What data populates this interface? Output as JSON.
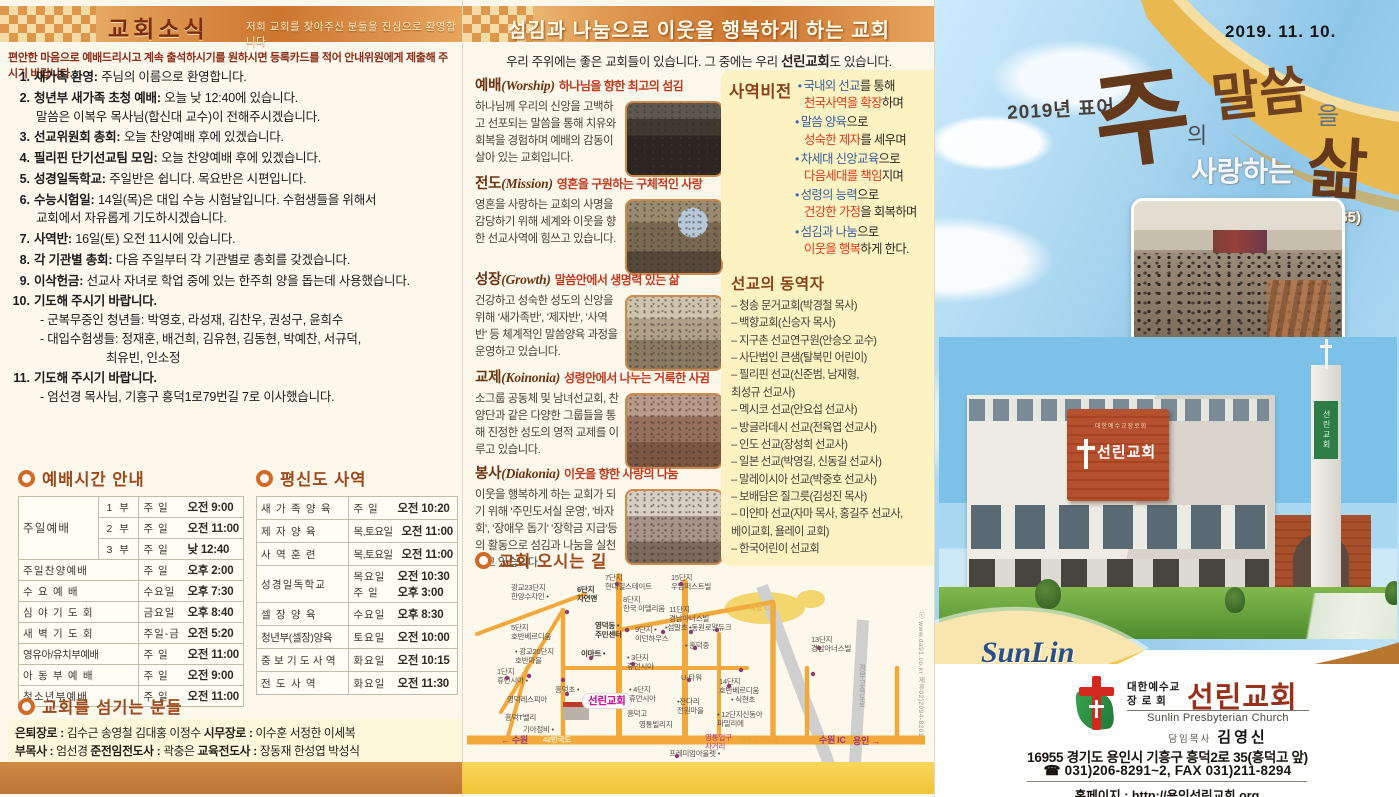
{
  "left": {
    "header": {
      "title": "교회소식",
      "welcome": "저희 교회를 찾아주신 분들을 진심으로 환영합니다"
    },
    "intro": "편안한 마음으로 예배드리시고 계속 출석하시기를 원하시면 등록카드를 적어 안내위원에게 제출해 주시기 바랍니다.",
    "announcements": [
      {
        "n": "1.",
        "t": "새가족 환영:",
        "b": "주님의 이름으로 환영합니다."
      },
      {
        "n": "2.",
        "t": "청년부 새가족 초청 예배:",
        "b": "오늘 낮 12:40에 있습니다.",
        "b2": "말씀은 이복우 목사님(합신대 교수)이 전해주시겠습니다."
      },
      {
        "n": "3.",
        "t": "선교위원회 총회:",
        "b": "오늘 찬양예배 후에 있겠습니다."
      },
      {
        "n": "4.",
        "t": "필리핀 단기선교팀 모임:",
        "b": "오늘 찬양예배 후에 있겠습니다."
      },
      {
        "n": "5.",
        "t": "성경일독학교:",
        "b": "주일반은 쉽니다. 목요반은 시편입니다."
      },
      {
        "n": "6.",
        "t": "수능시험일:",
        "b": "14일(목)은 대입 수능 시험날입니다. 수험생들을 위해서",
        "b2": "교회에서 자유롭게 기도하시겠습니다."
      },
      {
        "n": "7.",
        "t": "사역반:",
        "b": "16일(토) 오전 11시에 있습니다."
      },
      {
        "n": "8.",
        "t": "각 기관별 총회:",
        "b": "다음 주일부터 각 기관별로 총회를 갖겠습니다."
      },
      {
        "n": "9.",
        "t": "이삭헌금:",
        "b": "선교사 자녀로 학업 중에 있는 한주희 양을 돕는데 사용했습니다."
      },
      {
        "n": "10.",
        "t": "기도해 주시기 바랍니다.",
        "s1": "- 군복무중인 청년들: 박영호, 라성재, 김찬우, 권성구, 윤희수",
        "s2": "- 대입수험생들: 정재훈, 배건희, 김유현, 김동현, 박예찬, 서규덕,",
        "s3": "최유빈, 인소정"
      },
      {
        "n": "11.",
        "t": "기도해 주시기 바랍니다.",
        "s1": "- 엄선경 목사님, 기흥구 흥덕1로79번길 7로 이사했습니다."
      }
    ],
    "worship_times": {
      "title": "예배시간 안내",
      "rows": [
        {
          "name": "주일예배",
          "sub": "1 부",
          "day": "주  일",
          "time": "오전 9:00"
        },
        {
          "sub": "2 부",
          "day": "주  일",
          "time": "오전 11:00"
        },
        {
          "sub": "3 부",
          "day": "주  일",
          "time": "낮 12:40"
        },
        {
          "name": "주일찬양예배",
          "day": "주  일",
          "time": "오후 2:00"
        },
        {
          "name": "수 요 예 배",
          "day": "수요일",
          "time": "오후 7:30"
        },
        {
          "name": "심 야 기 도 회",
          "day": "금요일",
          "time": "오후 8:40"
        },
        {
          "name": "새 벽 기 도 회",
          "day": "주일-금",
          "time": "오전 5:20"
        },
        {
          "name": "영유아/유치부예배",
          "day": "주  일",
          "time": "오전 11:00"
        },
        {
          "name": "아 동 부 예 배",
          "day": "주  일",
          "time": "오전 9:00"
        },
        {
          "name": "청소년부예배",
          "day": "주  일",
          "time": "오전 11:00"
        }
      ]
    },
    "lay_ministry": {
      "title": "평신도 사역",
      "rows": [
        {
          "name": "새 가 족 양 육",
          "day": "주  일",
          "time": "오전 10:20"
        },
        {
          "name": "제 자 양 육",
          "day": "목,토요일",
          "time": "오전 11:00"
        },
        {
          "name": "사 역 훈 련",
          "day": "목,토요일",
          "time": "오전 11:00"
        },
        {
          "name": "성경일독학교",
          "day": "목요일",
          "time": "오전 10:30",
          "day2": "주  일",
          "time2": "오후 3:00"
        },
        {
          "name": "셀 장 양 육",
          "day": "수요일",
          "time": "오후 8:30"
        },
        {
          "name": "청년부(셀장)양육",
          "day": "토요일",
          "time": "오전 10:00"
        },
        {
          "name": "중 보 기 도 사 역",
          "day": "화요일",
          "time": "오전 10:15"
        },
        {
          "name": "전 도 사 역",
          "day": "화요일",
          "time": "오전 11:30"
        }
      ]
    },
    "servants": {
      "title": "교회를 섬기는 분들",
      "l1a": "은퇴장로 :",
      "l1b": " 김수근 송영철 김대홍 이정수",
      "l1c": "   시무장로 :",
      "l1d": " 이수훈 서정한 이세복",
      "l2a": "부목사 :",
      "l2b": " 엄선경 ",
      "l2c": "준전임전도사 :",
      "l2d": " 곽충은 ",
      "l2e": "교육전도사 :",
      "l2f": " 장동재 한성엽 박성식",
      "l3a": "지휘:",
      "l3b": " 부성우 ",
      "l3c": "반주:",
      "l3d": " 최현실 김효정 라미영 안소희 노신희 ",
      "l3e": "관현악:",
      "l3f": " 이선자 김윤지 변희정 이찬희"
    }
  },
  "middle": {
    "header": "섬김과 나눔으로 이웃을 행복하게 하는 교회",
    "sub1": "우리 주위에는 좋은 교회들이 있습니다. 그 중에는 우리 ",
    "sub_b": "선린교회",
    "sub2": "도 있습니다.",
    "sections": [
      {
        "name": "예배",
        "en": "(Worship)",
        "tag": "하나님을 향한 최고의 섬김",
        "body": "하나님께 우리의 신앙을 고백하고 선포되는 말씀을 통해 치유와 회복을 경험하며 예배의 감동이 살아 있는 교회입니다."
      },
      {
        "name": "전도",
        "en": "(Mission)",
        "tag": "영혼을 구원하는 구체적인 사랑",
        "body": "영혼을 사랑하는 교회의 사명을 감당하기 위해 세계와 이웃을 향한 선교사역에 힘쓰고 있습니다."
      },
      {
        "name": "성장",
        "en": "(Growth)",
        "tag": "말씀안에서 생명력 있는 삶",
        "body": "건강하고 성숙한 성도의 신앙을 위해 '새가족반', '제자반', '사역반' 등 체계적인 말씀양육 과정을 운영하고 있습니다."
      },
      {
        "name": "교제",
        "en": "(Koinonia)",
        "tag": "성령안에서 나누는 거룩한 사귐",
        "body": "소그룹 공동체 및 남녀선교회, 찬양단과 같은 다양한 그룹들을 통해 진정한 성도의 영적 교제를 이루고 있습니다."
      },
      {
        "name": "봉사",
        "en": "(Diakonia)",
        "tag": "이웃을 향한 사랑의 나눔",
        "body": "이웃을 행복하게 하는 교회가 되기 위해 '주민도서실 운영', '바자회', '장애우 돕기' '장학금 지급'등의 활동으로 섬김과 나눔을 실천하고 있습니다."
      }
    ],
    "vision": {
      "title": "사역비전",
      "items": [
        {
          "b1": "국내외 선교",
          "k1": "를 통해",
          "r2": "천국사역을 확장",
          "k2": "하며"
        },
        {
          "b1": "말씀 양육",
          "k1": "으로",
          "r2": "성숙한 제자",
          "k2": "를 세우며"
        },
        {
          "b1": "차세대 신앙교육",
          "k1": "으로",
          "r2": "다음세대를 책임",
          "k2": "지며"
        },
        {
          "b1": "성령의 능력",
          "k1": "으로",
          "r2": "건강한 가정",
          "k2": "을 회복하며"
        },
        {
          "b1": "섬김과 나눔",
          "k1": "으로",
          "r2": "이웃을 행복",
          "k2": "하게 한다."
        }
      ]
    },
    "partners": {
      "title": "선교의 동역자",
      "items": [
        "– 청송 문거교회(박경철 목사)",
        "– 백향교회(신승자 목사)",
        "– 지구촌 선교연구원(안승오 교수)",
        "– 사단법인 큰샘(탈북민 어린이)",
        "– 필리핀 선교(신준범, 남재형,\n                최성규 선교사)",
        "– 멕시코 선교(안요섭 선교사)",
        "– 방글라데시 선교(전육엽 선교사)",
        "– 인도 선교(장성희 선교사)",
        "– 일본 선교(박영길, 신동길 선교사)",
        "– 말레이시아 선교(박중호 선교사)",
        "– 보배담은 질그릇(김성진 목사)",
        "– 미얀마 선교(자마 목사, 홍길주 선교사,\n                베이교회, 욜레이 교회)",
        "– 한국어린이 선교회"
      ]
    },
    "map": {
      "title": "교회 오시는 길",
      "credit": "ⓒ www.da91.co.kr  제휴02)2094-8201",
      "labels": [
        "7단지\n현대힐스테이트",
        "15단지\n우남퍼스트빌",
        "광교23단지\n한양수자인 •",
        "6단지\n자연앤",
        "8단지\n한국 아델리움",
        "11단지\n경남아너스빌",
        "태광 CC",
        "5단지\n호반베르디움",
        "영덕동 •\n주민센터",
        "9단지 •\n이던하우스",
        "•섬말초",
        "•동원로얄듀크",
        "• 흥덕중",
        "13단지\n경남아너스빌",
        "• 광교20단지\n호반마을",
        "이마트 •",
        "• 3단지\n휴먼시아",
        "1단지\n휴먼시아 •",
        "U-타워",
        "14단지\n호반베르디움",
        "흥덕초 •",
        "영덕레스피아",
        "선린교회",
        "• 4단지\n휴먼시아",
        "•잔다리\n전원마을",
        "• 식현초",
        "흥덕T밸리",
        "기아정비 •",
        "흥덕고",
        "영통빌리지",
        "• 12단지신동아\n파밀리에",
        "← 수원",
        "42번국도",
        "영통입구\n사거리",
        "영통고가도로",
        "수원 IC",
        "용인 →",
        "프레미엄아울렛 •",
        "경부고속도로"
      ]
    }
  },
  "right": {
    "date": "2019.  11.  10.",
    "motto_label": "2019년 표어",
    "slogan": {
      "c1": "주",
      "p1": "의",
      "c2": "말씀",
      "p2": "을",
      "mid": "사랑하는",
      "c3": "삶",
      "verse": "(시119:165)"
    },
    "sunlin": "SunLin",
    "building_sign_top": "대한예수교장로회",
    "building_sign": "선린교회",
    "tower_sign": "선린교회",
    "info": {
      "denom1": "대한예수교",
      "denom2": "장 로 회",
      "name": "선린교회",
      "en": "Sunlin Presbyterian Church",
      "pastor_label": "담임목사",
      "pastor": "김영신",
      "address": "16955 경기도 용인시 기흥구 흥덕2로 35(흥덕고 앞)",
      "tel": "☎ 031)206-8291~2,  FAX 031)211-8294",
      "homepage": "홈페이지 : http://용인선린교회.org"
    }
  },
  "colors": {
    "accent_orange": "#d06a24",
    "bar_gradient": "#cc7630",
    "vision_blue": "#38629f",
    "vision_red": "#da3a1a",
    "box_yellow": "#fdf2c2",
    "strip_brown": "#c6803f",
    "strip_yellow": "#f6cf4e"
  }
}
